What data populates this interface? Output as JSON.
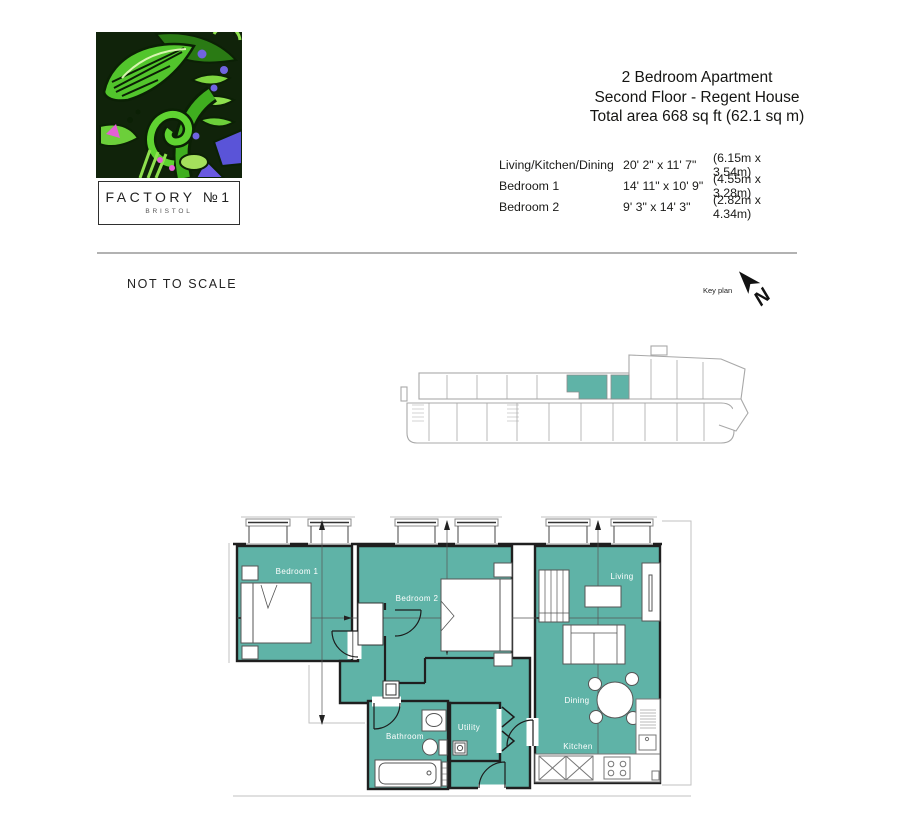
{
  "logo": {
    "brand": "FACTORY №1",
    "city": "BRISTOL"
  },
  "header": {
    "line1": "2 Bedroom Apartment",
    "line2": "Second Floor - Regent House",
    "line3": "Total area 668 sq ft (62.1 sq m)"
  },
  "dimensions_table": {
    "rows": [
      {
        "room": "Living/Kitchen/Dining",
        "imperial": "20' 2\" x 11' 7\"",
        "metric": "(6.15m x 3.54m)"
      },
      {
        "room": "Bedroom 1",
        "imperial": "14' 11\" x 10' 9\"",
        "metric": "(4.55m x 3.28m)"
      },
      {
        "room": "Bedroom 2",
        "imperial": "9' 3\" x 14' 3\"",
        "metric": "(2.82m x 4.34m)"
      }
    ]
  },
  "annotations": {
    "not_to_scale": "NOT TO SCALE",
    "key_plan": "Key plan",
    "north": "N"
  },
  "floor_plan": {
    "labels": {
      "bedroom1": "Bedroom 1",
      "bedroom2": "Bedroom 2",
      "living": "Living",
      "dining": "Dining",
      "kitchen": "Kitchen",
      "bathroom": "Bathroom",
      "utility": "Utility"
    }
  },
  "colors": {
    "accent_teal": "#5FB3A7",
    "wall": "#1F1F1F",
    "context_gray": "#BDBDBD"
  }
}
